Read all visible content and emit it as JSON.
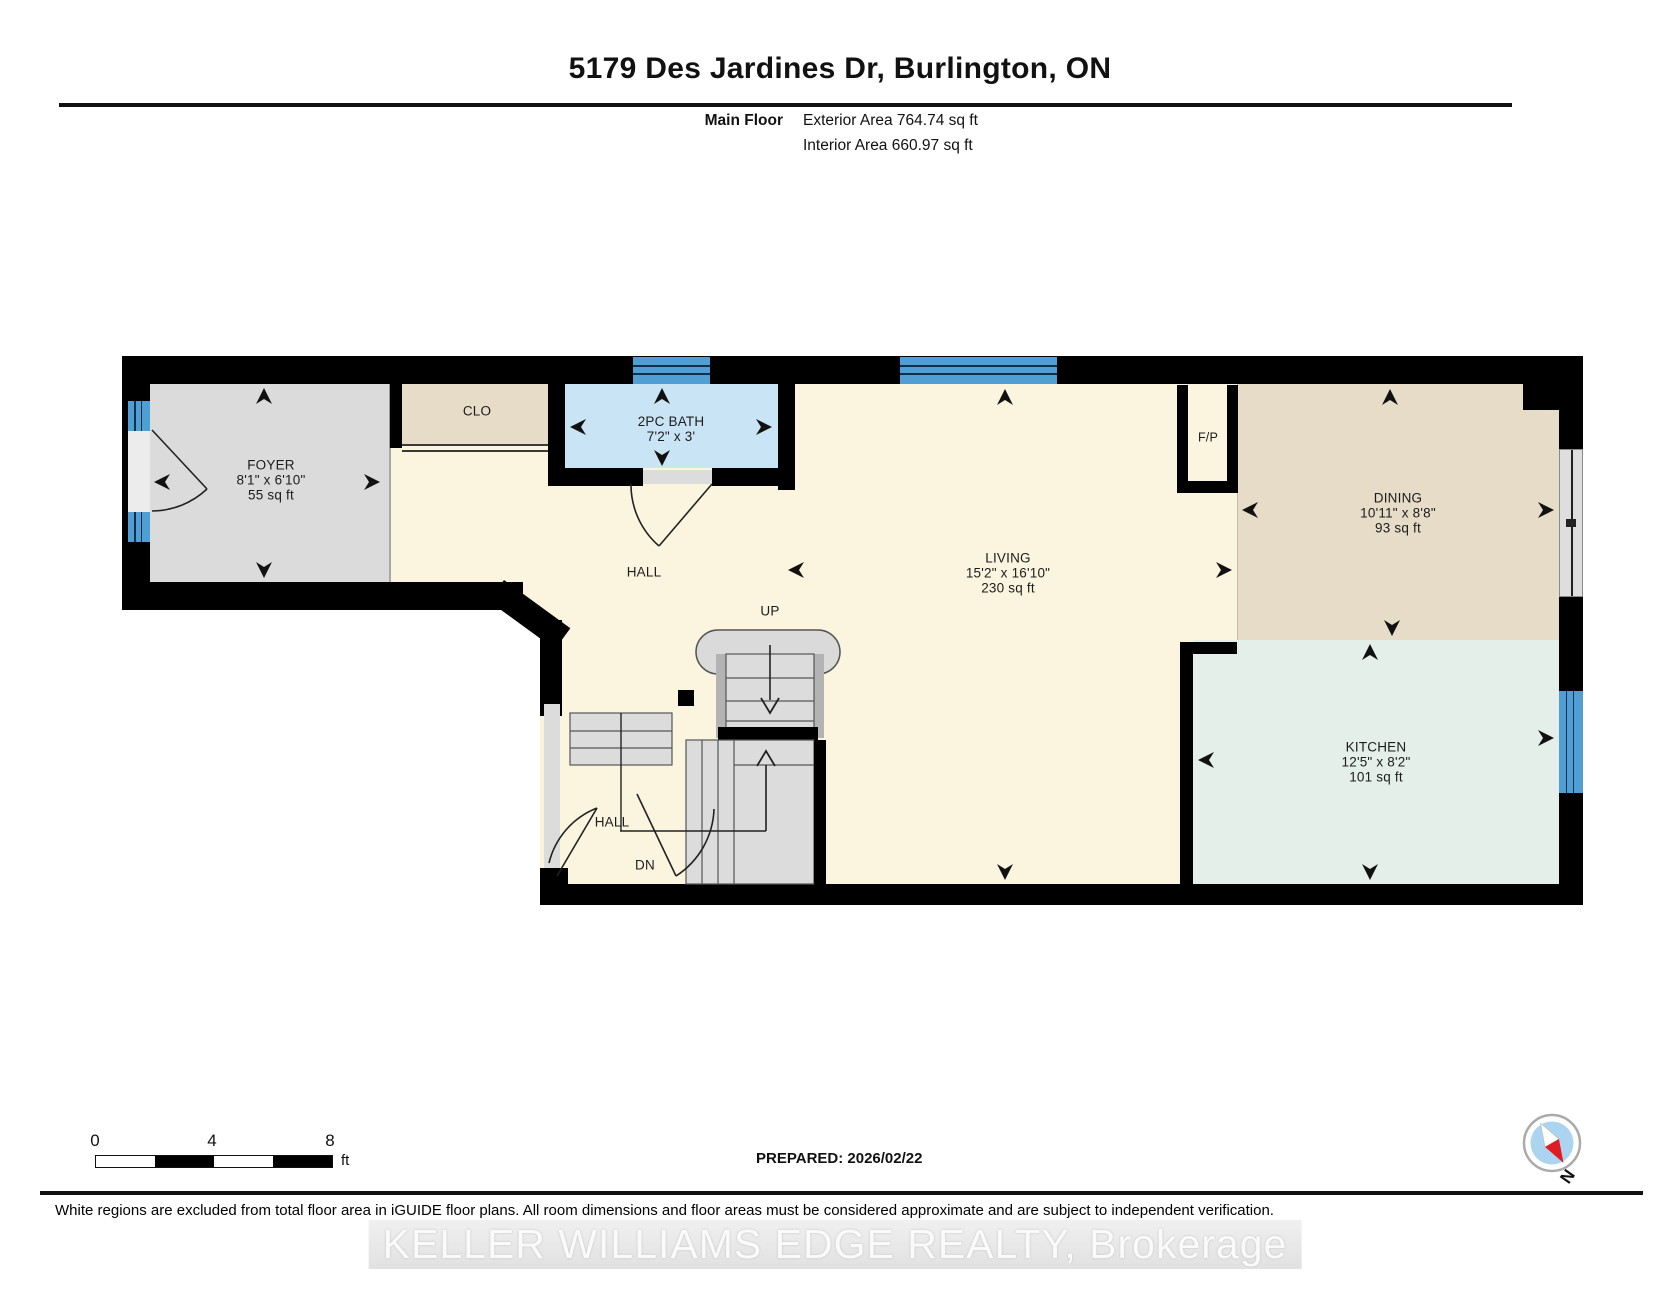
{
  "header": {
    "title": "5179 Des Jardines Dr, Burlington, ON",
    "floor_label": "Main Floor",
    "exterior_area": "Exterior Area 764.74 sq ft",
    "interior_area": "Interior Area 660.97 sq ft"
  },
  "rooms": {
    "foyer": {
      "name": "FOYER",
      "dims": "8'1\" x 6'10\"",
      "area": "55 sq ft"
    },
    "clo": {
      "name": "CLO"
    },
    "bath": {
      "name": "2PC BATH",
      "dims": "7'2\" x 3'"
    },
    "hall_upper": {
      "name": "HALL"
    },
    "up_label": "UP",
    "living": {
      "name": "LIVING",
      "dims": "15'2\" x 16'10\"",
      "area": "230 sq ft"
    },
    "fp": {
      "name": "F/P"
    },
    "dining": {
      "name": "DINING",
      "dims": "10'11\" x 8'8\"",
      "area": "93 sq ft"
    },
    "kitchen": {
      "name": "KITCHEN",
      "dims": "12'5\" x 8'2\"",
      "area": "101 sq ft"
    },
    "hall_lower": {
      "name": "HALL"
    },
    "dn_label": "DN"
  },
  "scale_bar": {
    "tick0": "0",
    "tick4": "4",
    "tick8": "8",
    "unit": "ft"
  },
  "footer": {
    "prepared": "PREPARED: 2026/02/22",
    "disclaimer": "White regions are excluded from total floor area in iGUIDE floor plans. All room dimensions and floor areas must be considered approximate and are subject to independent verification.",
    "watermark": "KELLER WILLIAMS EDGE REALTY, Brokerage",
    "compass_label": "N"
  },
  "colors": {
    "wall": "#000000",
    "floor_living": "#FBF5DF",
    "floor_foyer": "#DBDBDB",
    "floor_tan": "#E6DCC8",
    "floor_bath": "#C9E4F4",
    "floor_kitchen": "#E3EFE8",
    "window_blue": "#4F9FD5",
    "stair_gray": "#DCDCDC",
    "compass_red": "#E01B22",
    "compass_blue": "#ABD4F0"
  }
}
